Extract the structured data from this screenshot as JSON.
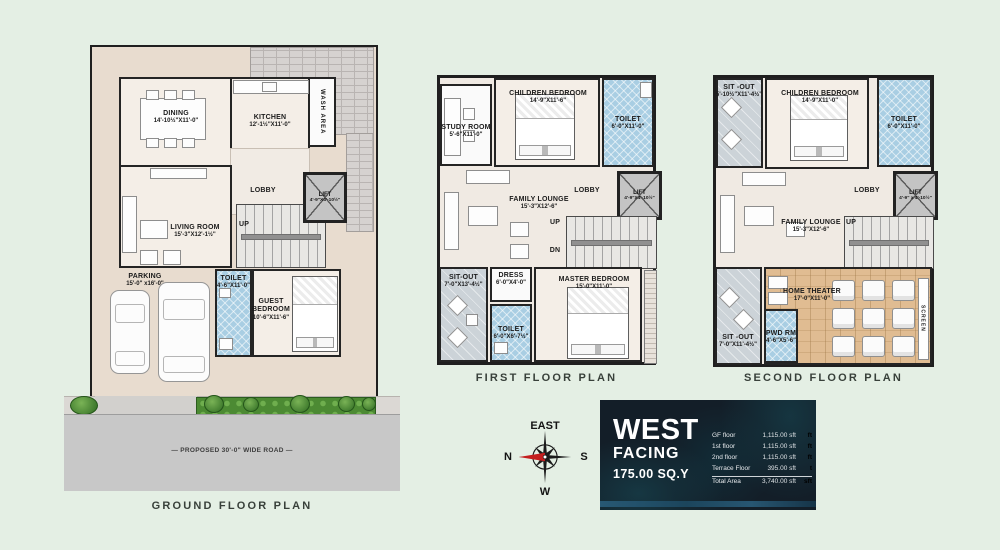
{
  "colors": {
    "background": "#e4efe4",
    "walls": "#222222",
    "toilet_blue": "#a9cee3",
    "sitout_gray": "#ccd3d8",
    "theater_wood": "#e0bc92",
    "greenery_green": "#4c8a33",
    "road_gray": "#c8c8c8",
    "card_navy": "#131e28",
    "compass_red": "#c41e1e"
  },
  "ground": {
    "title": "GROUND FLOOR PLAN",
    "road": "— PROPOSED 30'-0\" WIDE ROAD —",
    "dining": {
      "name": "DINING",
      "dims": "14'-10½\"X11'-0\""
    },
    "kitchen": {
      "name": "KITCHEN",
      "dims": "12'-1½\"X11'-0\""
    },
    "wash": {
      "name": "WASH AREA"
    },
    "lobby": {
      "name": "LOBBY"
    },
    "lift": {
      "name": "LIFT",
      "dims": "4'-9\"X4'-10½\""
    },
    "living": {
      "name": "LIVING ROOM",
      "dims": "15'-3\"X12'-1½\""
    },
    "up": "UP",
    "parking": {
      "name": "PARKING",
      "dims": "15'-0\" x16'-0\""
    },
    "toilet": {
      "name": "TOILET",
      "dims": "4'-6\"X11'-0\""
    },
    "guest": {
      "name": "GUEST BEDROOM",
      "dims": "10'-6\"X11'-6\""
    }
  },
  "first": {
    "title": "FIRST FLOOR PLAN",
    "study": {
      "name": "STUDY ROOM",
      "dims": "5'-6\"X11'-0\""
    },
    "children": {
      "name": "CHILDREN BEDROOM",
      "dims": "14'-9\"X11'-6\""
    },
    "toilet_top": {
      "name": "TOILET",
      "dims": "6'-0\"X11'-0\""
    },
    "family": {
      "name": "FAMILY LOUNGE",
      "dims": "15'-3\"X12'-6\""
    },
    "lobby": {
      "name": "LOBBY"
    },
    "lift": {
      "name": "LIFT",
      "dims": "4'-9\"X4'-10½\""
    },
    "up": "UP",
    "dn": "DN",
    "sitout": {
      "name": "SIT-OUT",
      "dims": "7'-0\"X13'-4½\""
    },
    "dress": {
      "name": "DRESS",
      "dims": "6'-0\"X4'-0\""
    },
    "toilet_bottom": {
      "name": "TOILET",
      "dims": "6'-0\"X6'-7½\""
    },
    "master": {
      "name": "MASTER BEDROOM",
      "dims": "15'-0\"X11'-0\""
    }
  },
  "second": {
    "title": "SECOND FLOOR PLAN",
    "sitout_top": {
      "name": "SIT -OUT",
      "dims": "5'-10½\"X11'-4½\""
    },
    "children": {
      "name": "CHILDREN BEDROOM",
      "dims": "14'-9\"X11'-0\""
    },
    "toilet": {
      "name": "TOILET",
      "dims": "6'-0\"X11'-0\""
    },
    "family": {
      "name": "FAMILY LOUNGE",
      "dims": "15'-3\"X12'-6\""
    },
    "lobby": {
      "name": "LOBBY"
    },
    "lift": {
      "name": "LIFT",
      "dims": "4'-9\" x 4'-10½\""
    },
    "up": "UP",
    "theater": {
      "name": "HOME THEATER",
      "dims": "17'-0\"X11'-0\""
    },
    "screen": "SCREEN",
    "pwd": {
      "name": "PWD RM",
      "dims": "4'-6\"X5'-6\""
    },
    "sitout_bottom": {
      "name": "SIT -OUT",
      "dims": "7'-0\"X11'-4½\""
    }
  },
  "compass": {
    "top": "EAST",
    "left": "N",
    "right": "S",
    "bottom": "W"
  },
  "info_card": {
    "facing_line1": "WEST",
    "facing_line2": "FACING",
    "facing_line3": "175.00 SQ.Y",
    "rows": [
      {
        "label": "GF floor",
        "value": "1,115.00 sft",
        "unit": "ft"
      },
      {
        "label": "1st floor",
        "value": "1,115.00 sft",
        "unit": "ft"
      },
      {
        "label": "2nd floor",
        "value": "1,115.00 sft",
        "unit": "ft"
      },
      {
        "label": "Terrace Floor",
        "value": "395.00 sft",
        "unit": "t"
      },
      {
        "label": "Total Area",
        "value": "3,740.00 sft",
        "unit": "sft"
      }
    ]
  }
}
